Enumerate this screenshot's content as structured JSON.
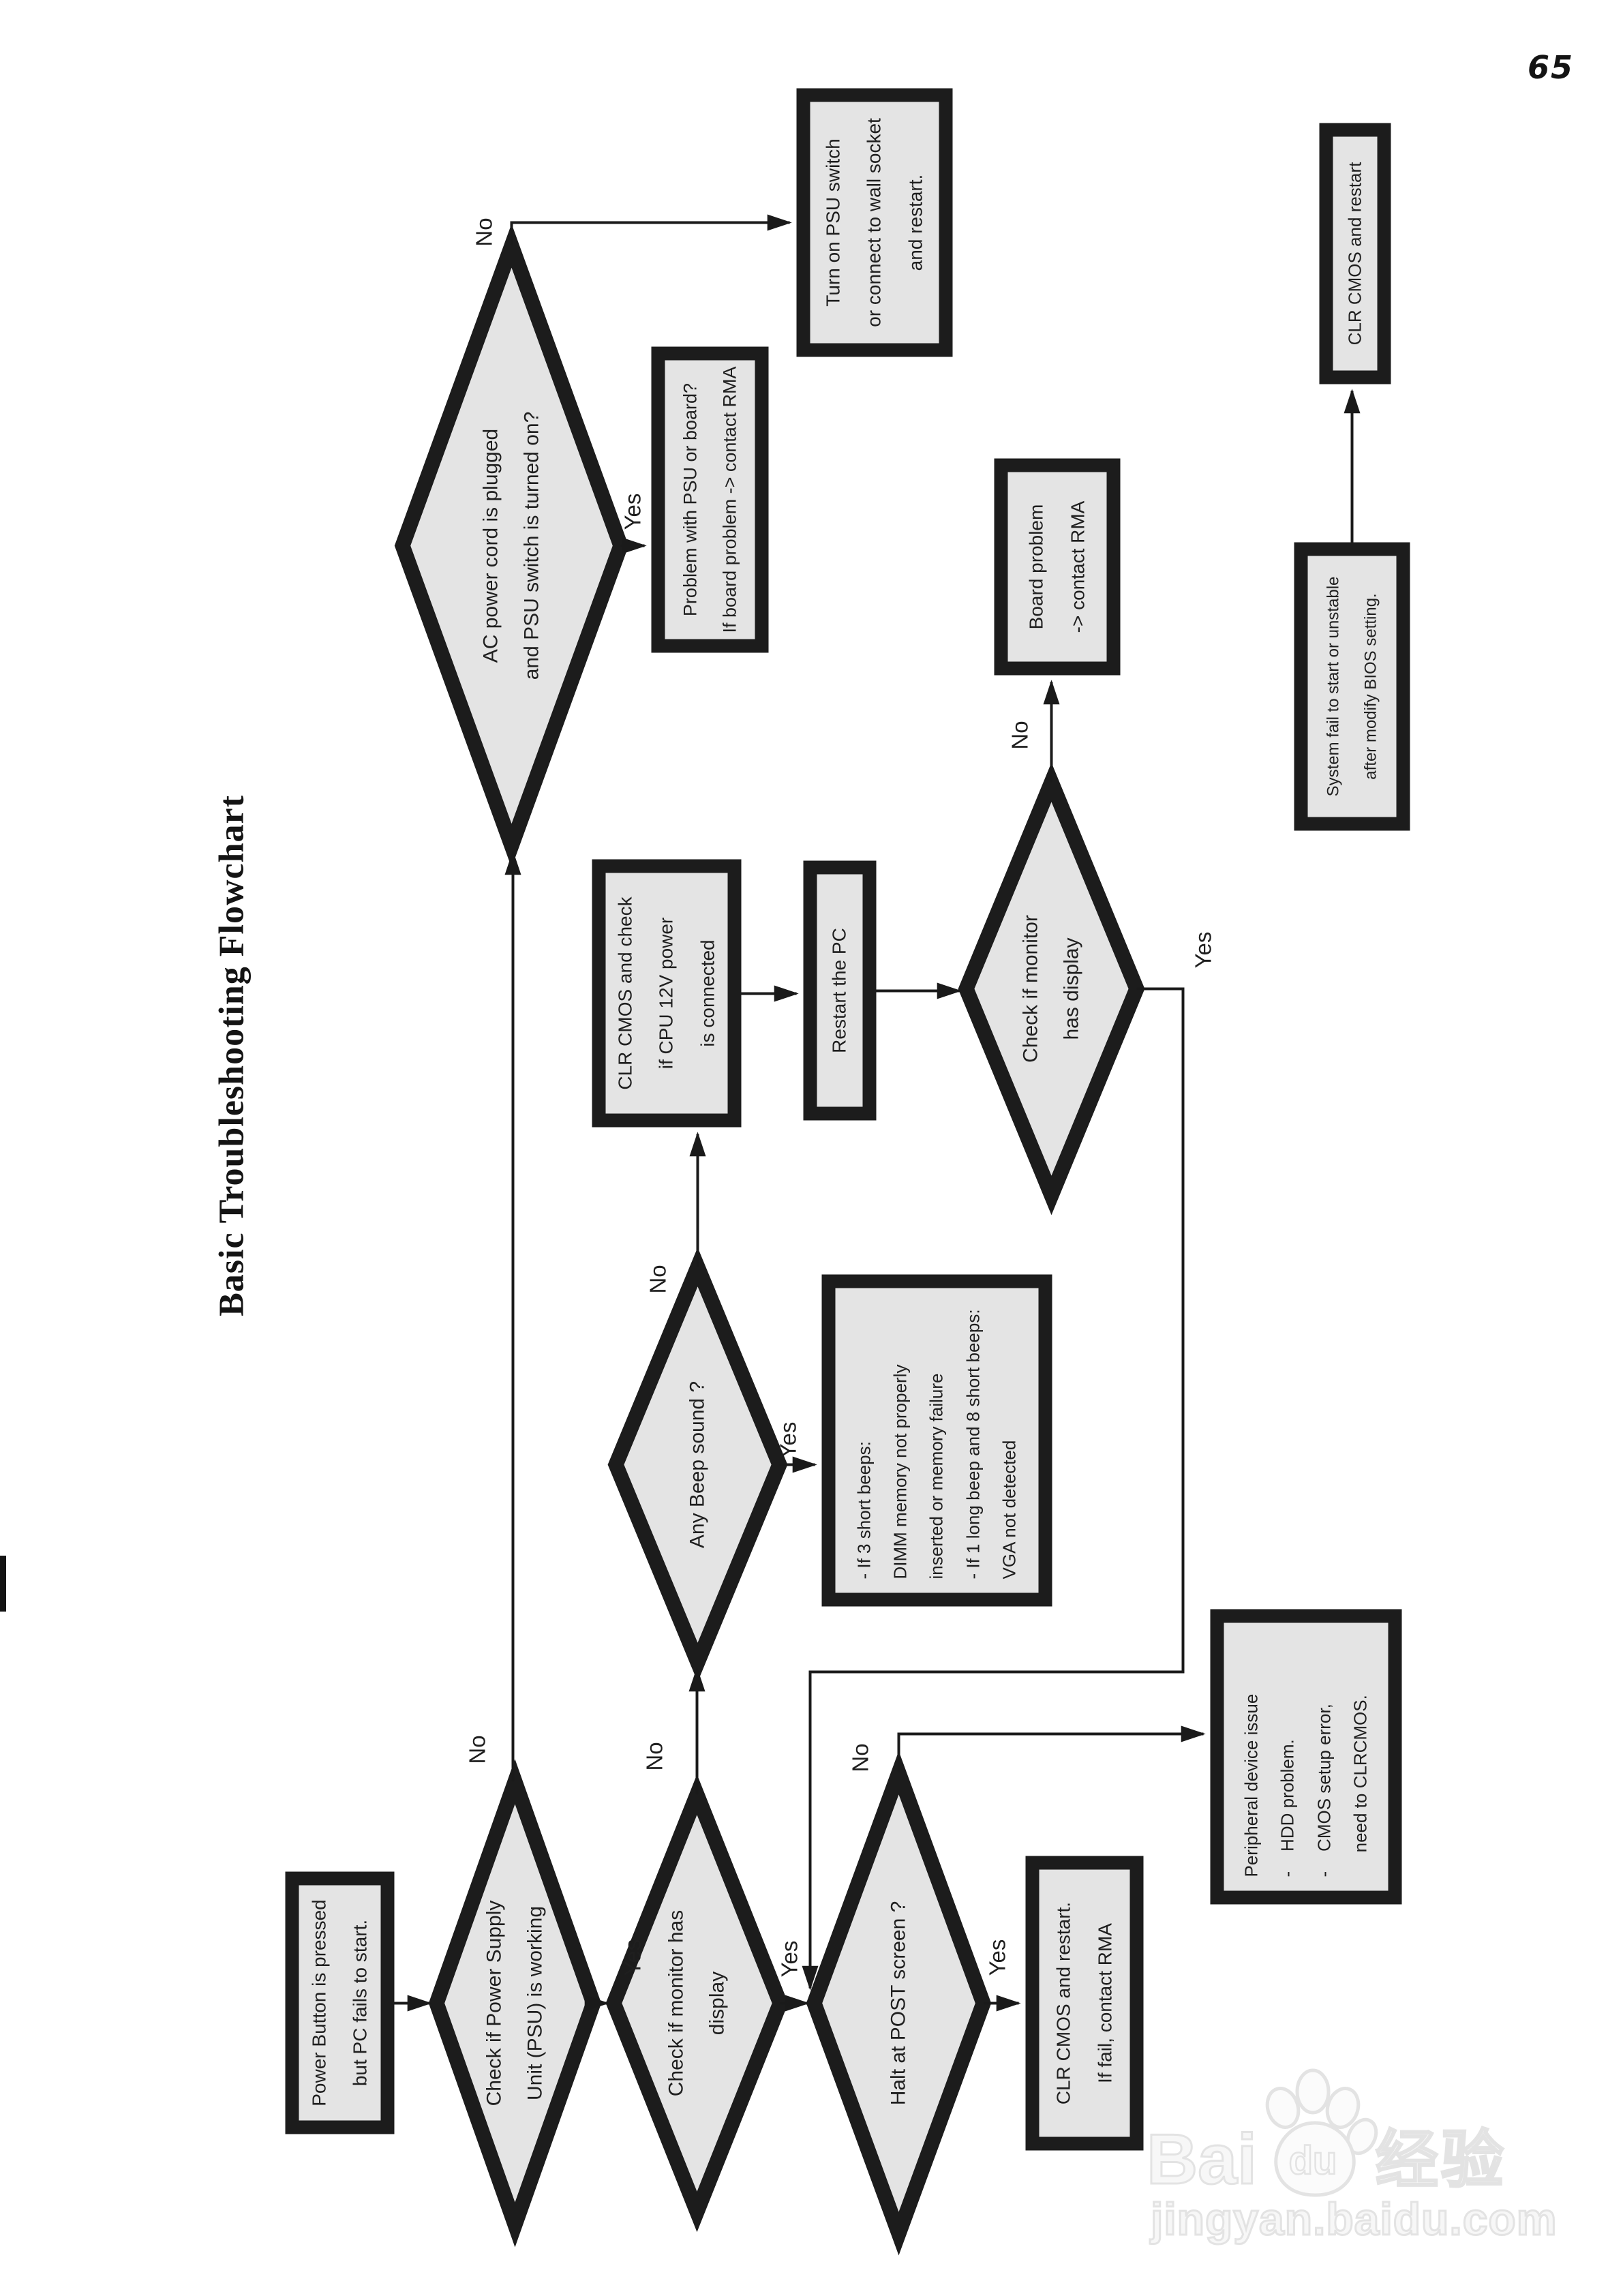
{
  "page": {
    "number": "65"
  },
  "title": "Basic Troubleshooting Flowchart",
  "labels": {
    "yes": "Yes",
    "no": "No"
  },
  "nodes": {
    "start": {
      "text": "Power Button is pressed\nbut PC fails to start."
    },
    "check_psu": {
      "text": "Check if Power Supply\nUnit (PSU) is working"
    },
    "check_monitor": {
      "text": "Check if monitor has\ndisplay"
    },
    "halt_post": {
      "text": "Halt at POST screen ?"
    },
    "clr_cmos_restart_rma": {
      "text": "CLR CMOS and restart.\nIf fail, contact RMA"
    },
    "peripheral": {
      "text": "Peripheral device issue\n-    HDD problem.\n-    CMOS setup error,\n     need to CLRCMOS."
    },
    "any_beep": {
      "text": "Any Beep sound ?"
    },
    "beep_info": {
      "text": "- If 3 short beeps:\nDIMM memory not properly\ninserted or memory failure\n- If 1 long beep and 8 short beeps:\nVGA not detected"
    },
    "clr_cmos_12v": {
      "text": "CLR CMOS and check\nif CPU 12V power\nis connected"
    },
    "restart_pc": {
      "text": "Restart the PC"
    },
    "check_monitor_2": {
      "text": "Check if monitor\nhas display"
    },
    "board_problem": {
      "text": "Board problem\n-> contact RMA"
    },
    "ac_power": {
      "text": "AC power cord is plugged\nand PSU switch is turned on?"
    },
    "turn_on_psu": {
      "text": "Turn on PSU switch\nor connect to wall socket\nand restart."
    },
    "problem_psu_board": {
      "text": "Problem with PSU or board?\nIf board problem -> contact RMA"
    },
    "system_fail": {
      "text": "System fail to start or unstable\nafter modify BIOS setting."
    },
    "clr_cmos_restart": {
      "text": "CLR CMOS and restart"
    }
  },
  "watermark": {
    "brand_latin": "Bai",
    "paw_text": "du",
    "brand_cn": "经验",
    "url": "jingyan.baidu.com"
  }
}
